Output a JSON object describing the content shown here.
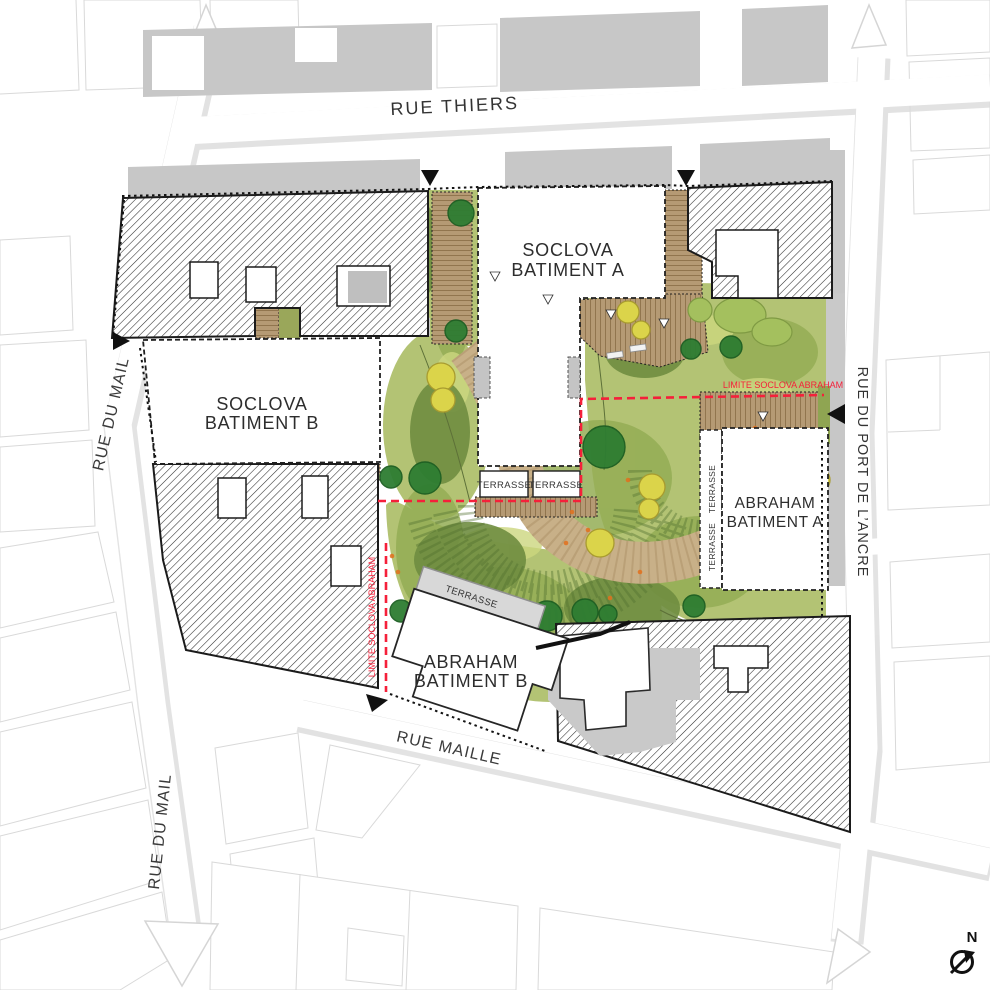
{
  "plan": {
    "streets": {
      "thiers": "RUE THIERS",
      "mail_upper": "RUE DU MAIL",
      "mail_lower": "RUE DU MAIL",
      "maille": "RUE MAILLE",
      "port_ancre": "RUE DU PORT DE L’ANCRE"
    },
    "buildings": {
      "soclova_a": {
        "line1": "SOCLOVA",
        "line2": "BATIMENT A"
      },
      "soclova_b": {
        "line1": "SOCLOVA",
        "line2": "BATIMENT B"
      },
      "abraham_a": {
        "line1": "ABRAHAM",
        "line2": "BATIMENT A"
      },
      "abraham_b": {
        "line1": "ABRAHAM",
        "line2": "BATIMENT B"
      }
    },
    "annotations": {
      "terrasse": "TERRASSE",
      "limite": "LIMITE SOCLOVA ABRAHAM",
      "north": "N"
    },
    "colors": {
      "limit_red": "#f5203a",
      "lawn_green": "#b3c374",
      "lawn_dark": "#6f8d40",
      "tree_green": "#2e7d32",
      "tree_yellow": "#dbd44a",
      "deck_tan": "#b59a74",
      "built_gray": "#c6c6c6",
      "hatch_ink": "#2b2b2b"
    }
  }
}
